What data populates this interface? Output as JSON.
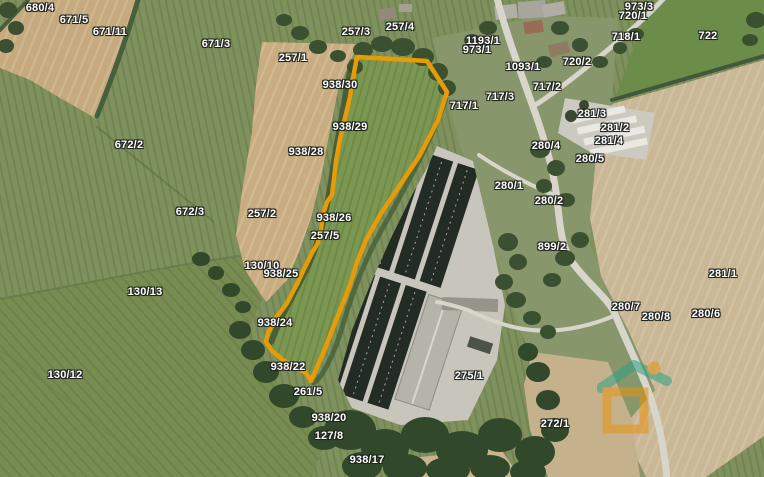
{
  "map": {
    "label_color": "#ffffff",
    "highlight": {
      "color": "#e79b06",
      "points": "357,57 427,61 447,92 438,120 420,155 400,185 380,215 366,240 357,262 350,285 341,308 331,333 322,356 311,381 306,373 295,367 283,360 272,351 266,342 268,333 276,318 287,303 297,284 304,269 312,253 318,243 321,229 323,214 327,202 332,195 334,179 336,161 340,139 345,118 350,97 353,78"
    },
    "watermark": {
      "roof_color": "#2fa287",
      "accent_color": "#e8940f"
    },
    "parcel_labels": [
      {
        "text": "680/4",
        "x": 40,
        "y": 8
      },
      {
        "text": "671/5",
        "x": 74,
        "y": 20
      },
      {
        "text": "671/11",
        "x": 110,
        "y": 32
      },
      {
        "text": "671/3",
        "x": 216,
        "y": 44
      },
      {
        "text": "257/3",
        "x": 356,
        "y": 32
      },
      {
        "text": "257/4",
        "x": 400,
        "y": 27
      },
      {
        "text": "257/1",
        "x": 293,
        "y": 58
      },
      {
        "text": "938/30",
        "x": 340,
        "y": 85
      },
      {
        "text": "1193/1",
        "x": 483,
        "y": 41
      },
      {
        "text": "973/1",
        "x": 477,
        "y": 50
      },
      {
        "text": "973/3",
        "x": 639,
        "y": 7
      },
      {
        "text": "720/1",
        "x": 633,
        "y": 16
      },
      {
        "text": "718/1",
        "x": 626,
        "y": 37
      },
      {
        "text": "722",
        "x": 708,
        "y": 36
      },
      {
        "text": "720/2",
        "x": 577,
        "y": 62
      },
      {
        "text": "1093/1",
        "x": 523,
        "y": 67
      },
      {
        "text": "717/2",
        "x": 547,
        "y": 87
      },
      {
        "text": "717/3",
        "x": 500,
        "y": 97
      },
      {
        "text": "717/1",
        "x": 464,
        "y": 106
      },
      {
        "text": "938/29",
        "x": 350,
        "y": 127
      },
      {
        "text": "938/28",
        "x": 306,
        "y": 152
      },
      {
        "text": "672/2",
        "x": 129,
        "y": 145
      },
      {
        "text": "281/3",
        "x": 592,
        "y": 114
      },
      {
        "text": "281/2",
        "x": 615,
        "y": 128
      },
      {
        "text": "281/4",
        "x": 609,
        "y": 141
      },
      {
        "text": "280/4",
        "x": 546,
        "y": 146
      },
      {
        "text": "280/5",
        "x": 590,
        "y": 159
      },
      {
        "text": "280/1",
        "x": 509,
        "y": 186
      },
      {
        "text": "280/2",
        "x": 549,
        "y": 201
      },
      {
        "text": "672/3",
        "x": 190,
        "y": 212
      },
      {
        "text": "257/2",
        "x": 262,
        "y": 214
      },
      {
        "text": "938/26",
        "x": 334,
        "y": 218
      },
      {
        "text": "257/5",
        "x": 325,
        "y": 236
      },
      {
        "text": "899/2",
        "x": 552,
        "y": 247
      },
      {
        "text": "130/10",
        "x": 262,
        "y": 266
      },
      {
        "text": "938/25",
        "x": 281,
        "y": 274
      },
      {
        "text": "281/1",
        "x": 723,
        "y": 274
      },
      {
        "text": "130/13",
        "x": 145,
        "y": 292
      },
      {
        "text": "280/7",
        "x": 626,
        "y": 307
      },
      {
        "text": "280/8",
        "x": 656,
        "y": 317
      },
      {
        "text": "280/6",
        "x": 706,
        "y": 314
      },
      {
        "text": "938/24",
        "x": 275,
        "y": 323
      },
      {
        "text": "938/22",
        "x": 288,
        "y": 367
      },
      {
        "text": "130/12",
        "x": 65,
        "y": 375
      },
      {
        "text": "261/5",
        "x": 308,
        "y": 392
      },
      {
        "text": "275/1",
        "x": 469,
        "y": 376
      },
      {
        "text": "938/20",
        "x": 329,
        "y": 418
      },
      {
        "text": "127/8",
        "x": 329,
        "y": 436
      },
      {
        "text": "272/1",
        "x": 555,
        "y": 424
      },
      {
        "text": "938/17",
        "x": 367,
        "y": 460
      }
    ]
  }
}
